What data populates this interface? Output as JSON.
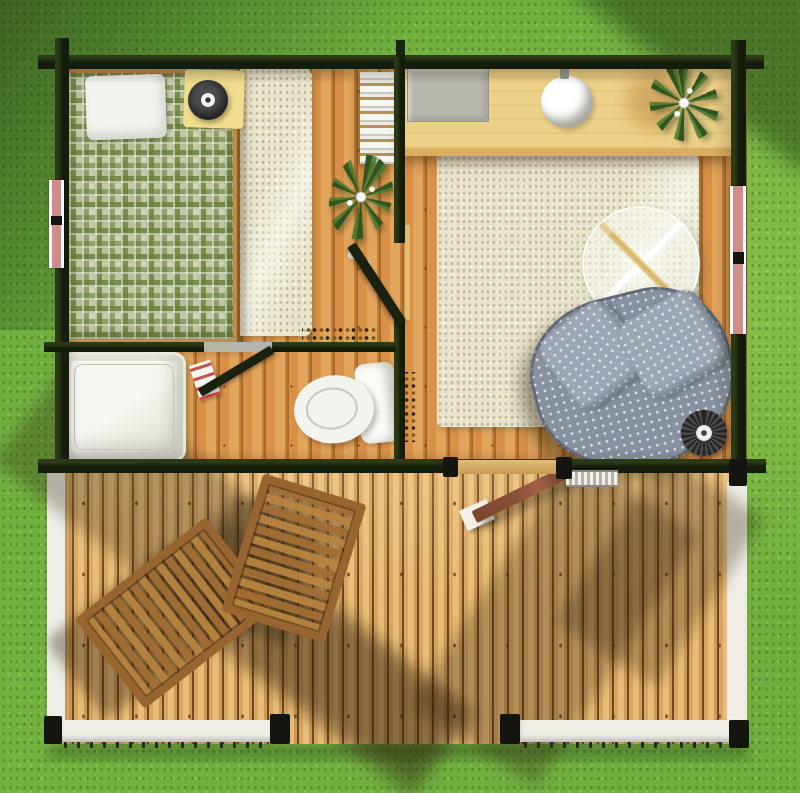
{
  "scene": {
    "type": "3d-floor-plan-render",
    "view": "top-down",
    "description": "Top-down 3D rendering of a small log cabin on a grass lawn: bedroom with plaid bed, living room with kitchenette counter and curved sofa, bathroom with shower and toilet, and a large front timber deck with two wooden lounge chairs and white railings."
  },
  "palette": {
    "grass": "#6fae3f",
    "wall": "#1a2410",
    "floor": "#d89147",
    "floor_seam": "#a76a2e",
    "deck": "#ddab64",
    "deck_seam": "#6a4a26",
    "deck_trim": "#efeee6",
    "counter": "#eed189",
    "rug": "#e9e4cb",
    "plaid_white": "#edeeda",
    "plaid_green": "#6a803a",
    "bed_frame": "#c38c49",
    "sofa": "#87919f",
    "sofa_cushion": "#9ca6b4",
    "window_pink": "#d18c8c",
    "plant_green": "#2f5520",
    "chair_wood": "#a06c33",
    "door_brown": "#8a4f38",
    "appliance_gray": "#b7b7ae",
    "fixture_white": "#f6f6f0",
    "fan_black": "#1c1c1c"
  },
  "rooms": {
    "bedroom": {
      "label": "bedroom",
      "furniture": [
        "plaid-single-bed",
        "white-pillow",
        "shag-rug",
        "table-fan-on-yellow-mat",
        "white-shelf-stack",
        "potted-plant",
        "wall-hooks"
      ]
    },
    "living_room": {
      "label": "living-room",
      "furniture": [
        "kitchen-counter",
        "gray-cooktop",
        "round-sink-with-faucet",
        "potted-plant",
        "shag-rug",
        "round-glass-table",
        "curved-dotted-sofa",
        "floor-fan"
      ]
    },
    "bathroom": {
      "label": "bathroom",
      "furniture": [
        "shower-tray",
        "toilet",
        "striped-towel",
        "swing-door"
      ]
    },
    "deck": {
      "label": "front-deck",
      "furniture": [
        "lounge-chair-left",
        "lounge-chair-upper",
        "open-front-door",
        "striped-doormat",
        "white-railing-segments",
        "corner-posts"
      ]
    }
  },
  "counts": {
    "windows": 2,
    "lounge_chairs": 2,
    "potted_plants": 2,
    "fans": 2,
    "doors": 3
  }
}
